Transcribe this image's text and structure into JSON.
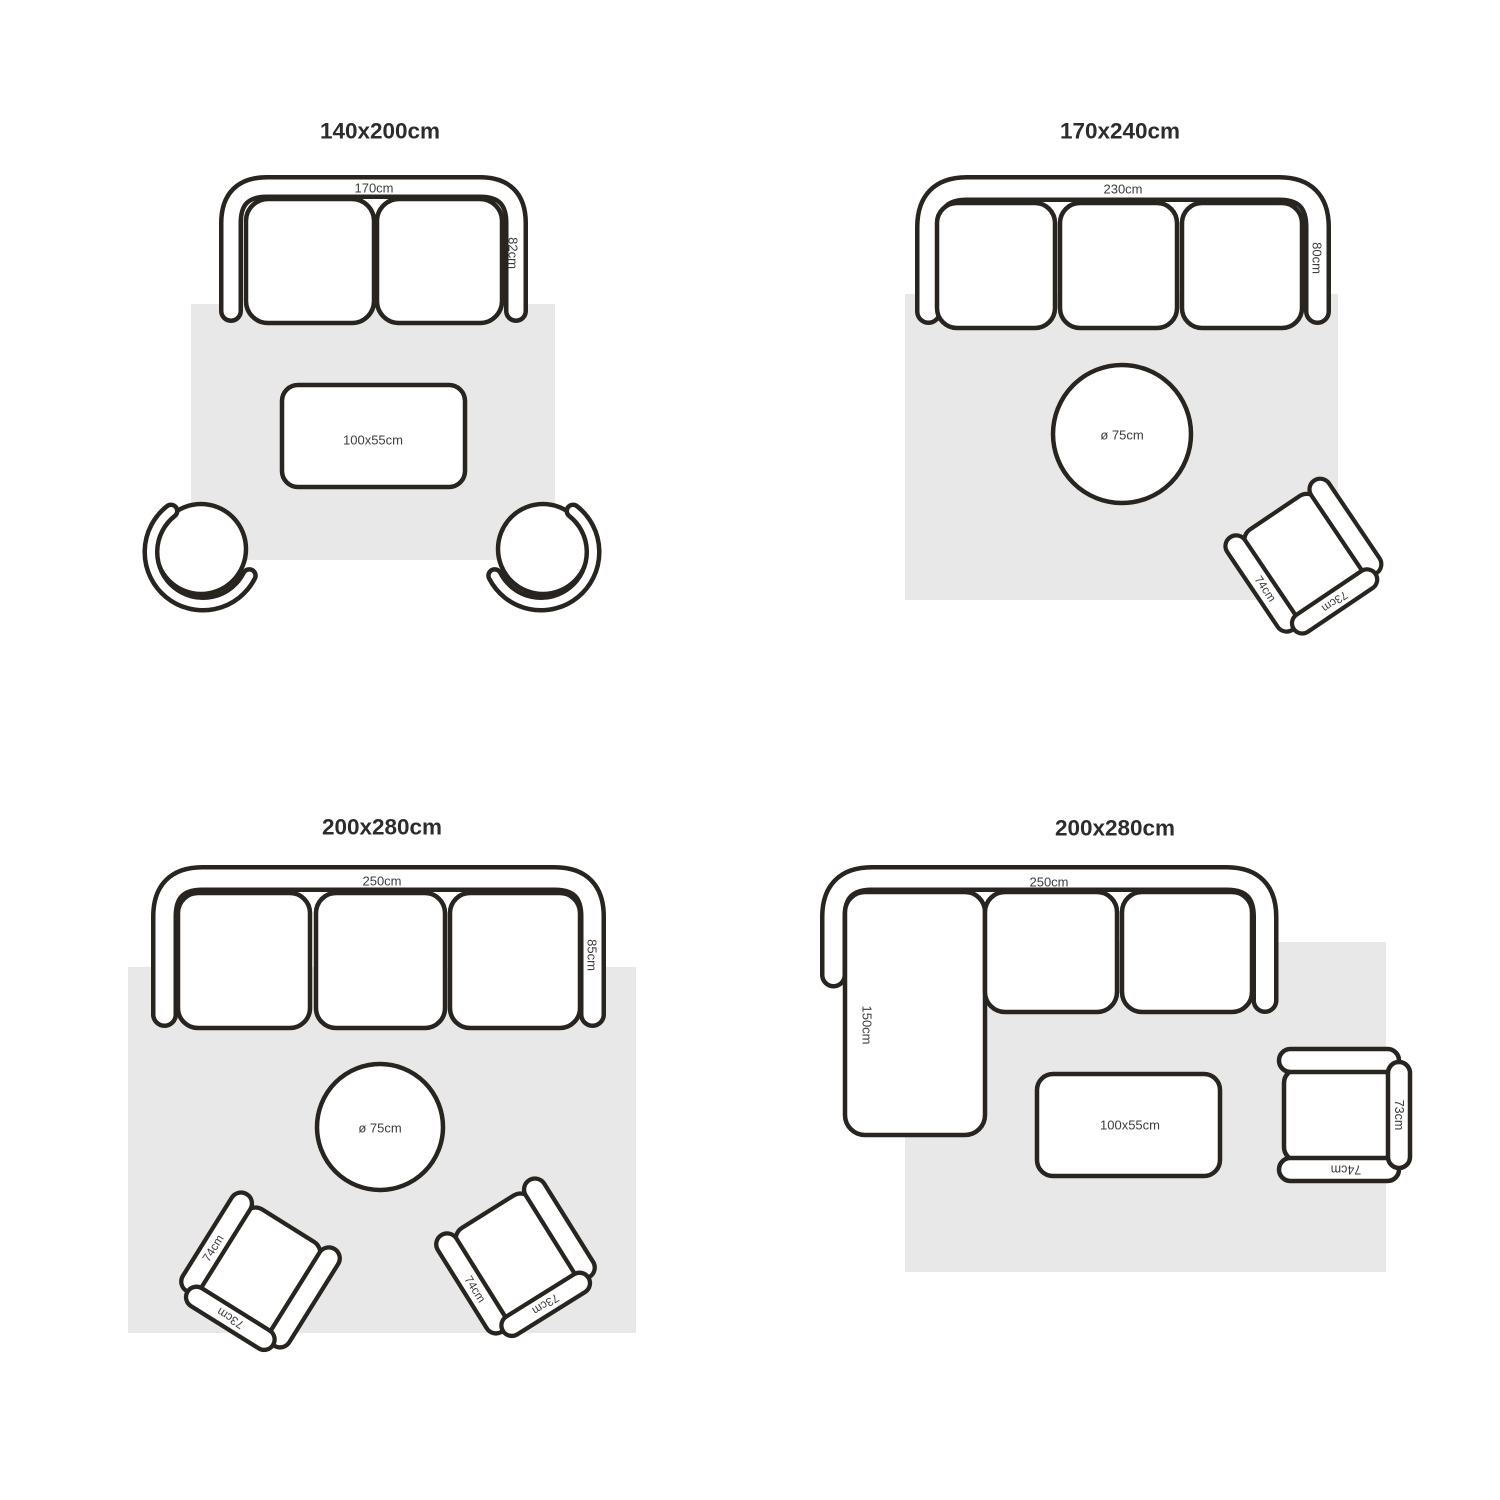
{
  "colors": {
    "outline": "#282420",
    "rug": "#e9e8e8",
    "label": "#3d3d3d",
    "title": "#2c2c2c",
    "background": "#ffffff"
  },
  "panels": [
    {
      "title": "140x200cm",
      "sofa": {
        "width_label": "170cm",
        "depth_label": "82cm",
        "seats": 2
      },
      "table_label": "100x55cm"
    },
    {
      "title": "170x240cm",
      "sofa": {
        "width_label": "230cm",
        "depth_label": "80cm",
        "seats": 3
      },
      "round_table_label": "ø 75cm",
      "chair": {
        "side_label": "74cm",
        "back_label": "73cm"
      }
    },
    {
      "title": "200x280cm",
      "sofa": {
        "width_label": "250cm",
        "depth_label": "85cm",
        "seats": 3
      },
      "round_table_label": "ø 75cm",
      "chairs": [
        {
          "side_label": "74cm",
          "back_label": "73cm"
        },
        {
          "side_label": "74cm",
          "back_label": "73cm"
        }
      ]
    },
    {
      "title": "200x280cm",
      "sofa": {
        "width_label": "250cm",
        "chaise_label": "150cm",
        "seats": 2
      },
      "table_label": "100x55cm",
      "chair": {
        "side_label": "74cm",
        "back_label": "73cm"
      }
    }
  ]
}
